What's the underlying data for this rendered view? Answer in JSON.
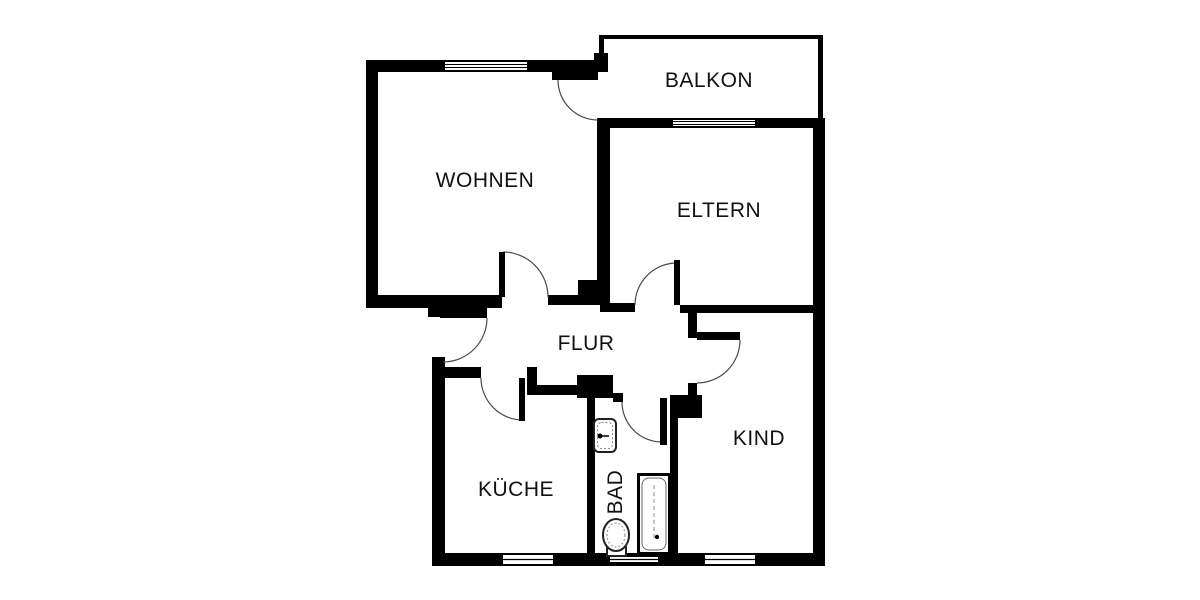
{
  "title": "apartment-floor-plan",
  "colors": {
    "wall": "#000000",
    "background": "#ffffff",
    "door_arc": "#4a4a4a",
    "fixture_stroke": "#222222",
    "fixture_detail": "#888888",
    "text": "#111111"
  },
  "rooms": [
    {
      "id": "balkon",
      "label": "BALKON",
      "x": 709,
      "y": 81,
      "rot": 0
    },
    {
      "id": "wohnen",
      "label": "WOHNEN",
      "x": 485,
      "y": 181,
      "rot": 0
    },
    {
      "id": "eltern",
      "label": "ELTERN",
      "x": 719,
      "y": 211,
      "rot": 0
    },
    {
      "id": "flur",
      "label": "FLUR",
      "x": 586,
      "y": 344,
      "rot": 0
    },
    {
      "id": "kueche",
      "label": "KÜCHE",
      "x": 516,
      "y": 490,
      "rot": 0
    },
    {
      "id": "bad",
      "label": "BAD",
      "x": 616,
      "y": 492,
      "rot": -90
    },
    {
      "id": "kind",
      "label": "KIND",
      "x": 759,
      "y": 439,
      "rot": 0
    }
  ],
  "plan": {
    "walls": [
      [
        366,
        60,
        12,
        248
      ],
      [
        366,
        60,
        79,
        12
      ],
      [
        527,
        60,
        81,
        12
      ],
      [
        366,
        295,
        136,
        13
      ],
      [
        428,
        303,
        14,
        14
      ],
      [
        432,
        357,
        13,
        196
      ],
      [
        432,
        553,
        71,
        13
      ],
      [
        553,
        553,
        55,
        13
      ],
      [
        608,
        553,
        97,
        13
      ],
      [
        755,
        553,
        70,
        13
      ],
      [
        813,
        118,
        12,
        448
      ],
      [
        597,
        118,
        76,
        10
      ],
      [
        755,
        118,
        65,
        10
      ],
      [
        597,
        118,
        13,
        165
      ],
      [
        578,
        280,
        32,
        25
      ],
      [
        548,
        295,
        32,
        10
      ],
      [
        600,
        303,
        35,
        9
      ],
      [
        680,
        305,
        133,
        8
      ],
      [
        688,
        313,
        9,
        25
      ],
      [
        688,
        383,
        9,
        17
      ],
      [
        670,
        395,
        32,
        23
      ],
      [
        670,
        418,
        8,
        135
      ],
      [
        445,
        367,
        36,
        11
      ],
      [
        527,
        367,
        10,
        28
      ],
      [
        530,
        385,
        60,
        10
      ],
      [
        577,
        375,
        36,
        23
      ],
      [
        613,
        393,
        10,
        9
      ],
      [
        587,
        398,
        8,
        155
      ],
      [
        594,
        53,
        14,
        19
      ]
    ],
    "thin_walls": [
      [
        599,
        35,
        224,
        4
      ],
      [
        599,
        35,
        5,
        22
      ],
      [
        818,
        35,
        5,
        85
      ]
    ],
    "windows": [
      {
        "x": 445,
        "y": 60,
        "w": 82,
        "h": 12,
        "mid": 2
      },
      {
        "x": 673,
        "y": 118,
        "w": 82,
        "h": 10,
        "mid": 2
      },
      {
        "x": 503,
        "y": 553,
        "w": 50,
        "h": 13,
        "mid": 1
      },
      {
        "x": 610,
        "y": 555,
        "w": 48,
        "h": 9,
        "mid": 1
      },
      {
        "x": 705,
        "y": 553,
        "w": 50,
        "h": 13,
        "mid": 1
      }
    ],
    "door_leaves": [
      [
        552,
        72,
        46,
        8
      ],
      [
        499,
        252,
        6,
        45
      ],
      [
        674,
        260,
        6,
        45
      ],
      [
        440,
        308,
        47,
        10
      ],
      [
        519,
        378,
        6,
        43
      ],
      [
        660,
        398,
        7,
        47
      ],
      [
        697,
        332,
        43,
        8
      ]
    ],
    "door_arcs": [
      {
        "x1": 558,
        "y1": 80,
        "x2": 598,
        "y2": 120,
        "r": 40,
        "sweep": 0
      },
      {
        "x1": 503,
        "y1": 252,
        "x2": 548,
        "y2": 297,
        "r": 45,
        "sweep": 1
      },
      {
        "x1": 635,
        "y1": 305,
        "x2": 677,
        "y2": 263,
        "r": 42,
        "sweep": 1
      },
      {
        "x1": 487,
        "y1": 318,
        "x2": 443,
        "y2": 362,
        "r": 44,
        "sweep": 1
      },
      {
        "x1": 481,
        "y1": 378,
        "x2": 523,
        "y2": 420,
        "r": 42,
        "sweep": 0
      },
      {
        "x1": 622,
        "y1": 402,
        "x2": 662,
        "y2": 442,
        "r": 40,
        "sweep": 0
      },
      {
        "x1": 740,
        "y1": 340,
        "x2": 697,
        "y2": 383,
        "r": 43,
        "sweep": 1
      }
    ],
    "fixtures": {
      "sink": {
        "x": 594,
        "y": 419,
        "w": 22,
        "h": 33
      },
      "toilet": {
        "cx": 616,
        "cy": 535,
        "rx": 13,
        "ry": 16,
        "tank": [
          607,
          547,
          19,
          9
        ]
      },
      "bathtub": {
        "x": 637,
        "y": 473,
        "w": 34,
        "h": 82
      }
    }
  }
}
